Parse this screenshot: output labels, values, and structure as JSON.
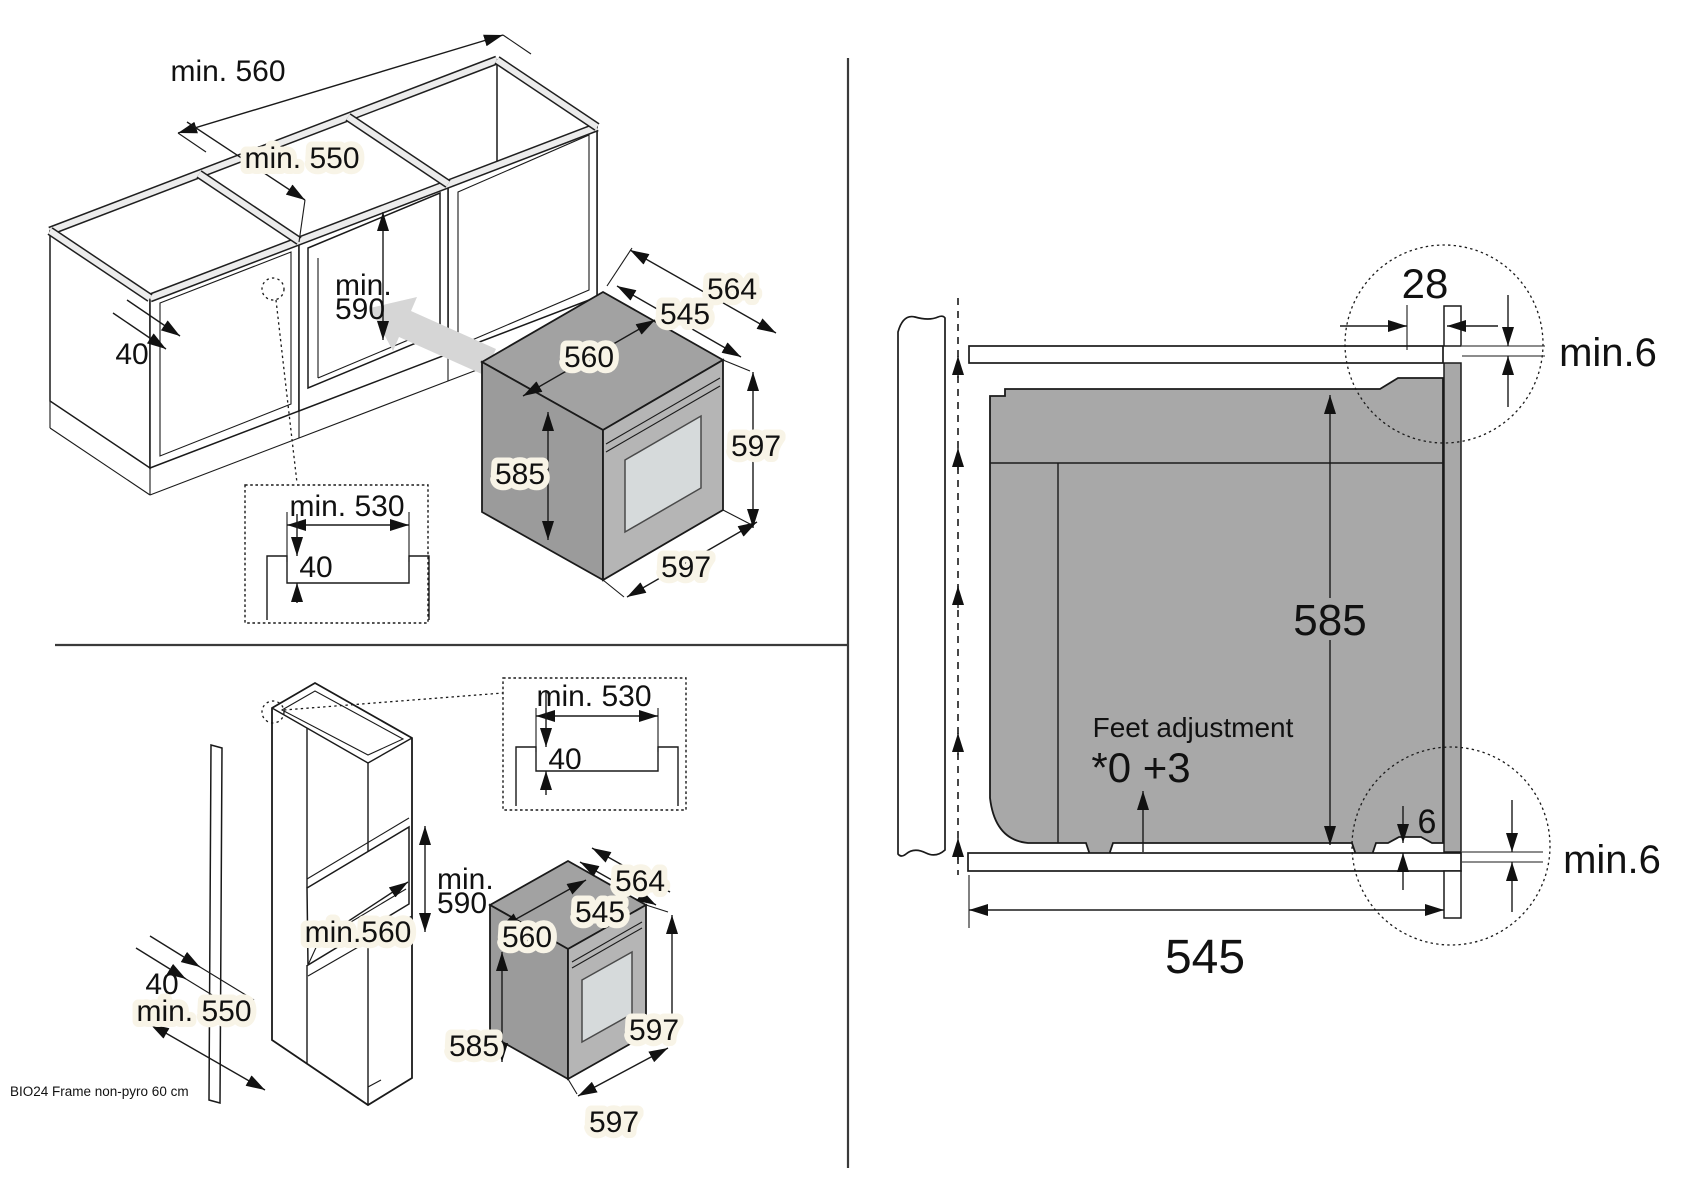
{
  "footer": {
    "model": "BIO24 Frame non-pyro 60 cm"
  },
  "colors": {
    "body_gray": "#a8a8a8",
    "rail_gray": "#ececec",
    "arrow_gray": "#d6d6d6",
    "window_gray": "#d6dadb",
    "line": "#1a1a1a"
  },
  "base": {
    "niche_width": "min. 560",
    "niche_depth": "min. 550",
    "niche_height_1": "min.",
    "niche_height_2": "590",
    "front_rail": "40",
    "inset": {
      "width": "min. 530",
      "recess": "40"
    },
    "oven": {
      "depth_total": "564",
      "depth_body": "545",
      "width_body": "560",
      "height_body": "585",
      "height_front": "597",
      "width_front": "597"
    }
  },
  "tall": {
    "niche_height_1": "min.",
    "niche_height_2": "590",
    "niche_width": "min.560",
    "front_rail": "40",
    "niche_depth": "min. 550",
    "inset": {
      "width": "min. 530",
      "recess": "40"
    },
    "oven": {
      "depth_total": "564",
      "depth_body": "545",
      "width_body": "560",
      "height_body": "585",
      "height_front": "597",
      "width_front": "597"
    }
  },
  "section": {
    "front_offset": "28",
    "top_clearance": "min.6",
    "body_height": "585",
    "feet_label": "Feet adjustment",
    "feet_values": "*0 +3",
    "bottom_gap": "6",
    "bottom_clearance": "min.6",
    "body_depth": "545"
  }
}
